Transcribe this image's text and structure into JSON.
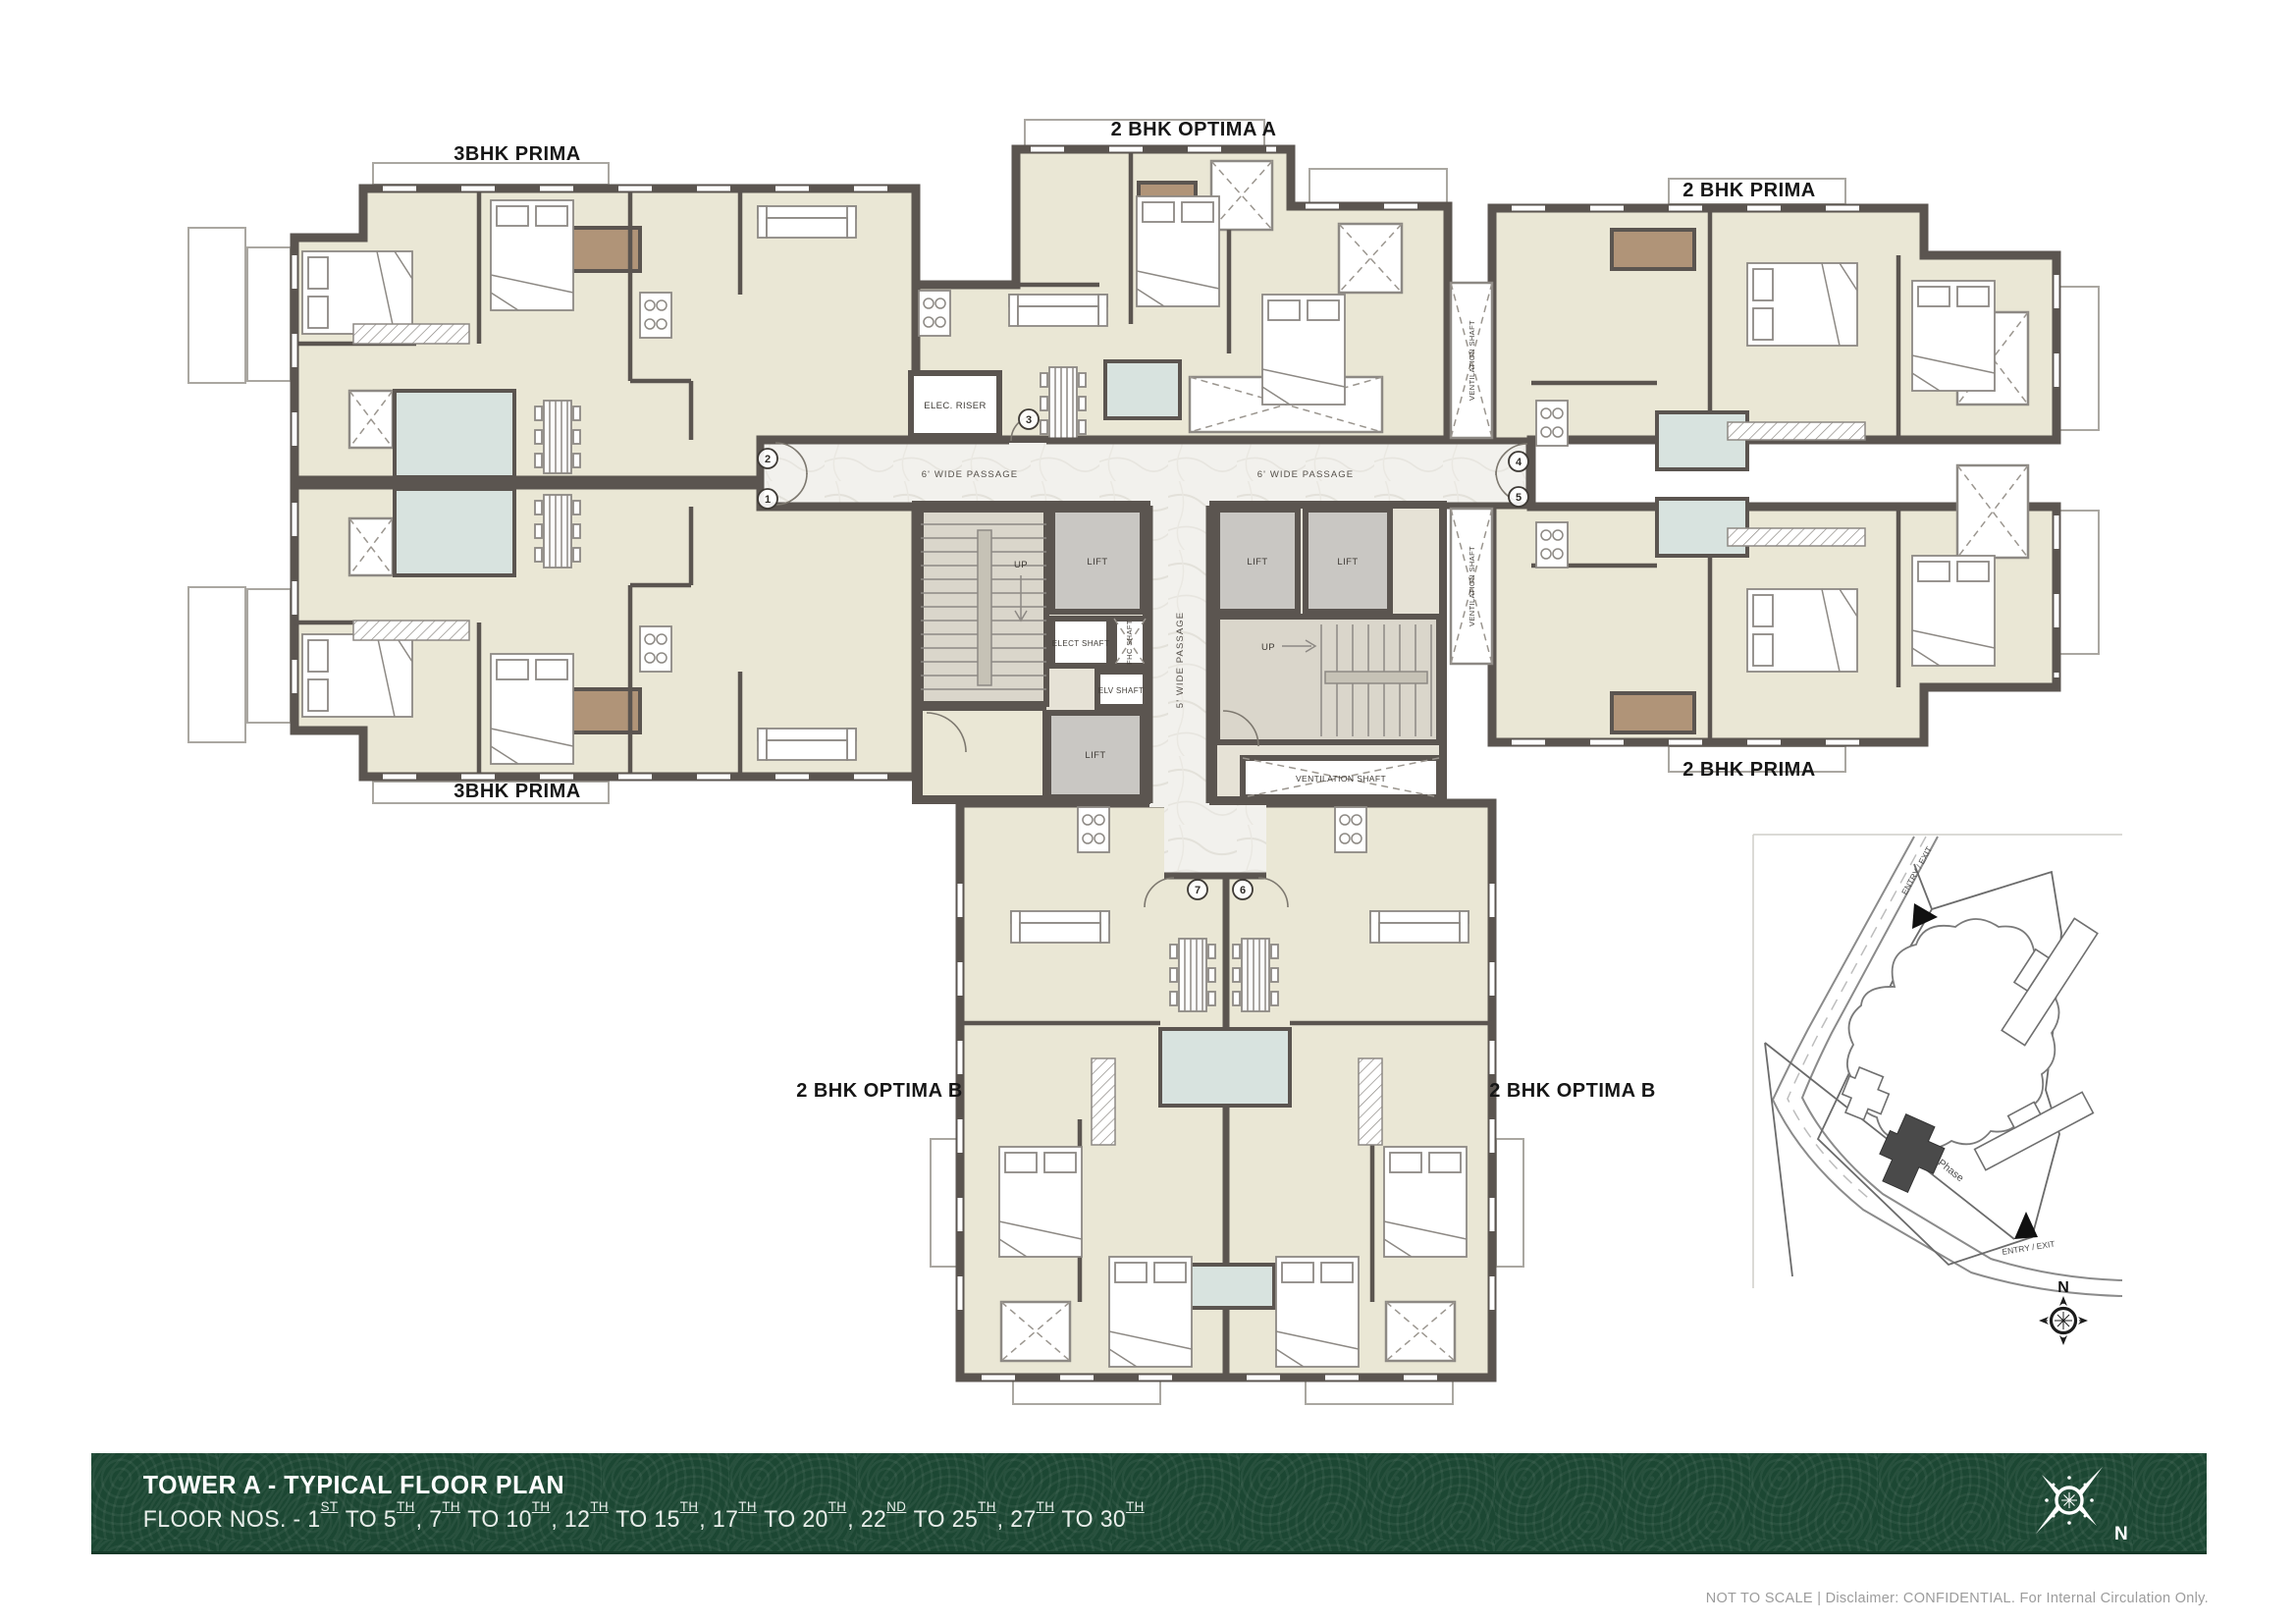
{
  "plan": {
    "unit_labels": [
      {
        "label": "3BHK PRIMA"
      },
      {
        "label": "2 BHK OPTIMA A"
      },
      {
        "label": "2 BHK PRIMA"
      },
      {
        "label": "3BHK PRIMA"
      },
      {
        "label": "2 BHK PRIMA"
      },
      {
        "label": "2 BHK OPTIMA B"
      },
      {
        "label": "2 BHK OPTIMA B"
      }
    ],
    "core_labels": {
      "lift": "LIFT",
      "up": "UP",
      "elect_shaft": "ELECT SHAFT",
      "fhc_shaft": "FHC SHAFT",
      "elv_shaft": "ELV SHAFT",
      "elec_riser": "ELEC. RISER",
      "ventilation_shaft": "VENTILATION SHAFT",
      "passage_6": "6' WIDE PASSAGE",
      "passage_5": "5' WIDE PASSAGE"
    },
    "entries": [
      "1",
      "2",
      "3",
      "4",
      "5",
      "6",
      "7"
    ]
  },
  "site_map": {
    "existing_phase_label": "Existing Completed Phase",
    "entry_exit_label": "ENTRY / EXIT",
    "north_label": "N"
  },
  "footer": {
    "title": "TOWER A - TYPICAL FLOOR PLAN",
    "north_label": "N",
    "floor_segments": [
      {
        "t": "FLOOR NOS. - "
      },
      {
        "t": "1",
        "sup": "ST"
      },
      {
        "t": " TO "
      },
      {
        "t": "5",
        "sup": "TH"
      },
      {
        "t": ", "
      },
      {
        "t": "7",
        "sup": "TH"
      },
      {
        "t": " TO "
      },
      {
        "t": "10",
        "sup": "TH"
      },
      {
        "t": ", "
      },
      {
        "t": "12",
        "sup": "TH"
      },
      {
        "t": " TO "
      },
      {
        "t": "15",
        "sup": "TH"
      },
      {
        "t": ", "
      },
      {
        "t": "17",
        "sup": "TH"
      },
      {
        "t": " TO "
      },
      {
        "t": "20",
        "sup": "TH"
      },
      {
        "t": ", "
      },
      {
        "t": "22",
        "sup": "ND"
      },
      {
        "t": " TO "
      },
      {
        "t": "25",
        "sup": "TH"
      },
      {
        "t": ", "
      },
      {
        "t": "27",
        "sup": "TH"
      },
      {
        "t": " TO "
      },
      {
        "t": "30",
        "sup": "TH"
      }
    ]
  },
  "footnote": {
    "text": "NOT TO SCALE | Disclaimer: CONFIDENTIAL. For Internal Circulation Only."
  },
  "colors": {
    "wall": "#5b5550",
    "floor": "#eae7d5",
    "bath": "#d8e3df",
    "marble": "#f2f1ed",
    "lift": "#c9c7c3",
    "deck": "#b09478",
    "footer_green": "#1c4733",
    "footnote_gray": "#9c9c9c"
  }
}
